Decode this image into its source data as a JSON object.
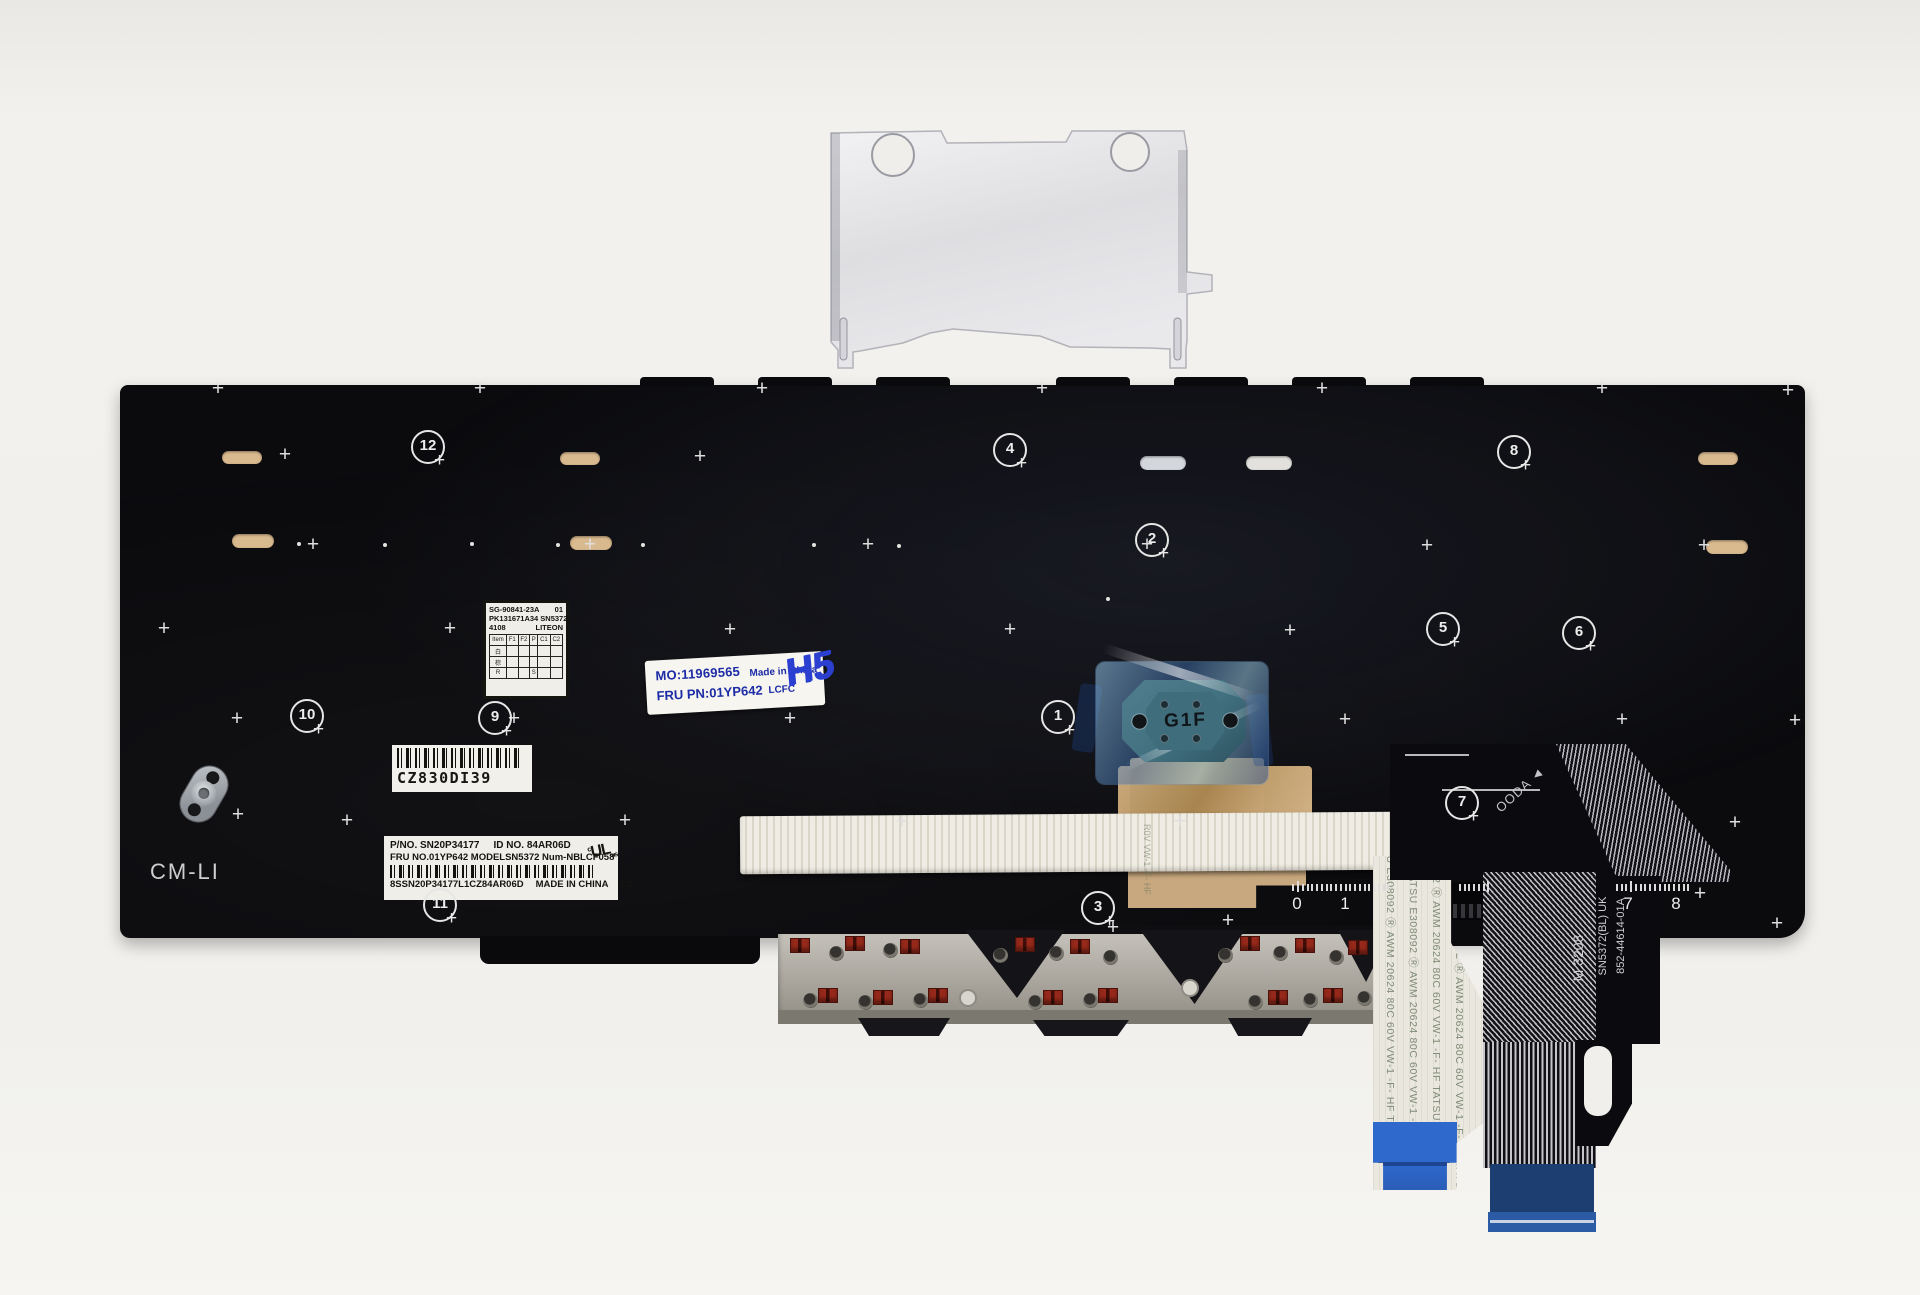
{
  "colors": {
    "plate": "#0b0b0e",
    "kapton": "#c8a87e",
    "clip_red": "#8a2318",
    "connector_blue": "#2f69cc",
    "stiffener_navy": "#1c3e70",
    "end_blue": "#2c5ba6",
    "sticker_blue": "#1c2ba6",
    "marker_blue": "#2b3fd0",
    "trackpoint_teal": "#41707f",
    "tan_pill": "#d9b98e"
  },
  "plate": {
    "cm_li": "CM-LI",
    "pills": [
      {
        "x": 222,
        "y": 451,
        "w": 40,
        "h": 13,
        "c": "#d9b98e"
      },
      {
        "x": 560,
        "y": 452,
        "w": 40,
        "h": 13,
        "c": "#d9b98e"
      },
      {
        "x": 1698,
        "y": 452,
        "w": 40,
        "h": 13,
        "c": "#d9b98e"
      },
      {
        "x": 232,
        "y": 534,
        "w": 42,
        "h": 14,
        "c": "#d9b98e"
      },
      {
        "x": 570,
        "y": 536,
        "w": 42,
        "h": 14,
        "c": "#d9b98e"
      },
      {
        "x": 1706,
        "y": 540,
        "w": 42,
        "h": 14,
        "c": "#d9b98e"
      },
      {
        "x": 1140,
        "y": 456,
        "w": 46,
        "h": 14,
        "c": "#d3d6da"
      },
      {
        "x": 1246,
        "y": 456,
        "w": 46,
        "h": 14,
        "c": "#e2e1dd"
      }
    ],
    "nubs": [
      [
        640,
        377,
        74
      ],
      [
        758,
        377,
        74
      ],
      [
        876,
        377,
        74
      ],
      [
        1056,
        377,
        74
      ],
      [
        1174,
        377,
        74
      ],
      [
        1292,
        377,
        74
      ],
      [
        1410,
        377,
        74
      ]
    ]
  },
  "callouts": [
    {
      "n": "1",
      "x": 1058,
      "y": 717
    },
    {
      "n": "2",
      "x": 1152,
      "y": 540
    },
    {
      "n": "3",
      "x": 1098,
      "y": 908
    },
    {
      "n": "4",
      "x": 1010,
      "y": 450
    },
    {
      "n": "5",
      "x": 1443,
      "y": 629
    },
    {
      "n": "6",
      "x": 1579,
      "y": 633
    },
    {
      "n": "7",
      "x": 1462,
      "y": 803
    },
    {
      "n": "8",
      "x": 1514,
      "y": 452
    },
    {
      "n": "9",
      "x": 495,
      "y": 718
    },
    {
      "n": "10",
      "x": 307,
      "y": 716
    },
    {
      "n": "11",
      "x": 440,
      "y": 905
    },
    {
      "n": "12",
      "x": 428,
      "y": 447
    }
  ],
  "plus_marks": [
    [
      218,
      390
    ],
    [
      480,
      390
    ],
    [
      762,
      390
    ],
    [
      1042,
      390
    ],
    [
      1322,
      390
    ],
    [
      1602,
      390
    ],
    [
      1788,
      392
    ],
    [
      285,
      456
    ],
    [
      700,
      458
    ],
    [
      313,
      546
    ],
    [
      590,
      546
    ],
    [
      868,
      546
    ],
    [
      1147,
      546
    ],
    [
      1427,
      547
    ],
    [
      1704,
      547
    ],
    [
      164,
      630
    ],
    [
      450,
      630
    ],
    [
      730,
      631
    ],
    [
      1010,
      631
    ],
    [
      1290,
      632
    ],
    [
      237,
      720
    ],
    [
      514,
      720
    ],
    [
      790,
      720
    ],
    [
      1345,
      721
    ],
    [
      1622,
      721
    ],
    [
      1795,
      722
    ],
    [
      238,
      816
    ],
    [
      347,
      822
    ],
    [
      625,
      822
    ],
    [
      902,
      823
    ],
    [
      1180,
      823
    ],
    [
      1735,
      824
    ],
    [
      1113,
      929
    ],
    [
      1228,
      922
    ],
    [
      1700,
      895
    ],
    [
      1777,
      925
    ]
  ],
  "dots": [
    [
      297,
      542
    ],
    [
      383,
      543
    ],
    [
      470,
      542
    ],
    [
      556,
      543
    ],
    [
      641,
      543
    ],
    [
      812,
      543
    ],
    [
      897,
      544
    ],
    [
      1106,
      597
    ]
  ],
  "ruler": {
    "origin": 1297,
    "unit": 47.6,
    "tick_ranges": [
      [
        1288,
        1392
      ],
      [
        1455,
        1489
      ],
      [
        1612,
        1689
      ]
    ],
    "numbers": [
      {
        "t": "0",
        "x": 1297
      },
      {
        "t": "1",
        "x": 1345
      },
      {
        "t": "7",
        "x": 1628
      },
      {
        "t": "8",
        "x": 1676
      }
    ]
  },
  "labels": {
    "liteon": {
      "l1a": "SG-90841-23A",
      "l1b": "01",
      "l2": "PK131671A34 SN53722",
      "l3a": "4108",
      "l3b": "LITEON",
      "table_head": [
        "Item",
        "F1",
        "F2",
        "P",
        "C1",
        "C2"
      ],
      "rows": [
        [
          "白",
          "",
          "",
          "",
          "",
          ""
        ],
        [
          "棕",
          "",
          "",
          "",
          "",
          ""
        ],
        [
          "R",
          "",
          "",
          "S",
          "",
          ""
        ]
      ]
    },
    "mo": {
      "l1": "MO:11969565",
      "l2": "FRU PN:01YP642",
      "r1": "Made in China",
      "r2": "LCFC",
      "hand": "H5"
    },
    "cz": {
      "text": "CZ830DI39"
    },
    "main": {
      "l1a": "P/NO. SN20P34177",
      "l1b": "ID NO. 84AR06D",
      "l2": "FRU NO.01YP642 MODELSN5372 Num-NBLCF058",
      "ul_c": "c",
      "ul": "UL",
      "ul_us": "us",
      "l3a": "8SSN20P34177L1CZ84AR06D",
      "l3b": "MADE IN CHINA",
      "l3c": "C2"
    }
  },
  "trackpoint": {
    "label": "G1F"
  },
  "cable_left": {
    "line": "TATSU E308092 Ⓡ AWM 20624 80C 60V VW-1 -F- HF  TATSU E308092 Ⓡ AWM 20624 80C 60V",
    "columns": [
      {
        "x": 14,
        "dy": -28
      },
      {
        "x": 37,
        "dy": 12
      },
      {
        "x": 60,
        "dy": -58
      },
      {
        "x": 83,
        "dy": 18
      }
    ],
    "faint": "R0V VW-1 -F- HF"
  },
  "cable_right": {
    "t1": "SN5372(BL) UK",
    "t2": "852-44614-01A",
    "t3": "M 3208",
    "t4": "OODA ◄"
  },
  "switch_area": {
    "clips": [
      [
        800,
        945
      ],
      [
        855,
        943
      ],
      [
        910,
        946
      ],
      [
        1025,
        944
      ],
      [
        1080,
        946
      ],
      [
        1250,
        943
      ],
      [
        1305,
        945
      ],
      [
        1358,
        947
      ],
      [
        828,
        995
      ],
      [
        883,
        997
      ],
      [
        938,
        995
      ],
      [
        1053,
        997
      ],
      [
        1108,
        995
      ],
      [
        1278,
        997
      ],
      [
        1333,
        995
      ]
    ],
    "pads": [
      [
        836,
        953
      ],
      [
        890,
        950
      ],
      [
        1000,
        955
      ],
      [
        1056,
        953
      ],
      [
        1110,
        957
      ],
      [
        1225,
        955
      ],
      [
        1280,
        953
      ],
      [
        1336,
        957
      ],
      [
        810,
        1000
      ],
      [
        865,
        1002
      ],
      [
        920,
        1000
      ],
      [
        1035,
        1002
      ],
      [
        1090,
        1000
      ],
      [
        1255,
        1002
      ],
      [
        1310,
        1000
      ],
      [
        1364,
        998
      ]
    ],
    "white_pads": [
      [
        968,
        998
      ],
      [
        1190,
        988
      ]
    ],
    "wedges": [
      {
        "x": 187,
        "y": 4,
        "w": 100,
        "h": 68
      },
      {
        "x": 362,
        "y": 4,
        "w": 105,
        "h": 74
      },
      {
        "x": 560,
        "y": 4,
        "w": 54,
        "h": 52
      }
    ],
    "tabs": [
      {
        "x": 80,
        "y": 92,
        "w": 92,
        "h": 18
      },
      {
        "x": 255,
        "y": 94,
        "w": 96,
        "h": 16
      },
      {
        "x": 450,
        "y": 92,
        "w": 84,
        "h": 18
      }
    ]
  }
}
